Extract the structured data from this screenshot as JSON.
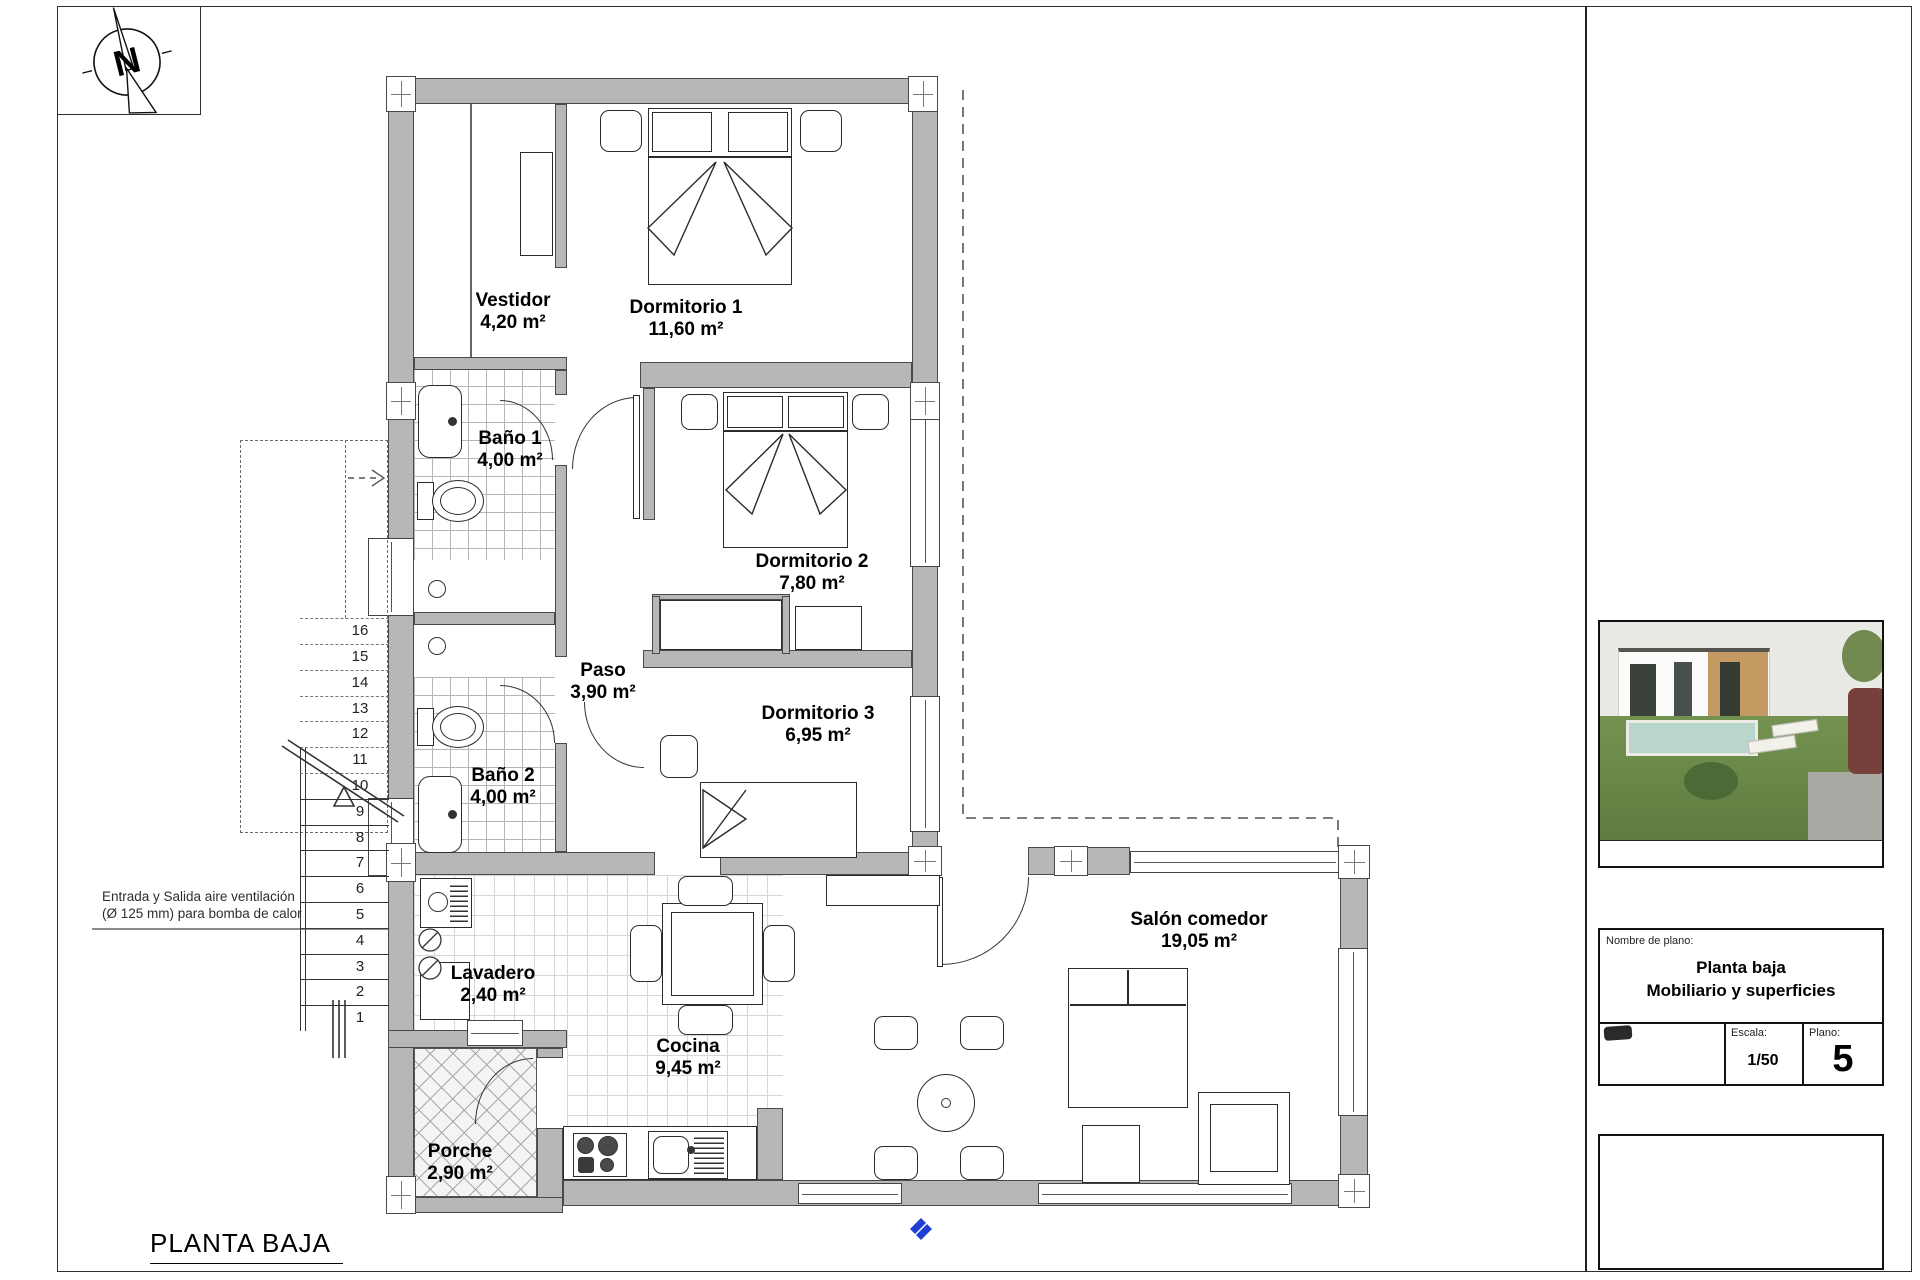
{
  "sheet": {
    "plan_title": "PLANTA BAJA"
  },
  "compass": {
    "label": "N"
  },
  "vent_note": {
    "line1": "Entrada y Salida aire ventilación",
    "line2": "(Ø 125 mm) para bomba de calor"
  },
  "rooms": [
    {
      "name": "Vestidor",
      "area": "4,20 m²"
    },
    {
      "name": "Dormitorio 1",
      "area": "11,60 m²"
    },
    {
      "name": "Baño 1",
      "area": "4,00 m²"
    },
    {
      "name": "Dormitorio 2",
      "area": "7,80 m²"
    },
    {
      "name": "Paso",
      "area": "3,90 m²"
    },
    {
      "name": "Dormitorio 3",
      "area": "6,95 m²"
    },
    {
      "name": "Baño 2",
      "area": "4,00 m²"
    },
    {
      "name": "Lavadero",
      "area": "2,40 m²"
    },
    {
      "name": "Cocina",
      "area": "9,45 m²"
    },
    {
      "name": "Porche",
      "area": "2,90 m²"
    },
    {
      "name": "Salón comedor",
      "area": "19,05 m²"
    }
  ],
  "stairs": {
    "steps": [
      "1",
      "2",
      "3",
      "4",
      "5",
      "6",
      "7",
      "8",
      "9",
      "10",
      "11",
      "12",
      "13",
      "14",
      "15",
      "16"
    ]
  },
  "title_block": {
    "name_label": "Nombre de plano:",
    "plan_name_line1": "Planta baja",
    "plan_name_line2": "Mobiliario y superficies",
    "scale_label": "Escala:",
    "scale_value": "1/50",
    "sheet_label": "Plano:",
    "sheet_number": "5"
  },
  "colors": {
    "wall": "#b7b7b7",
    "accent_blue": "#1f3fd4"
  }
}
